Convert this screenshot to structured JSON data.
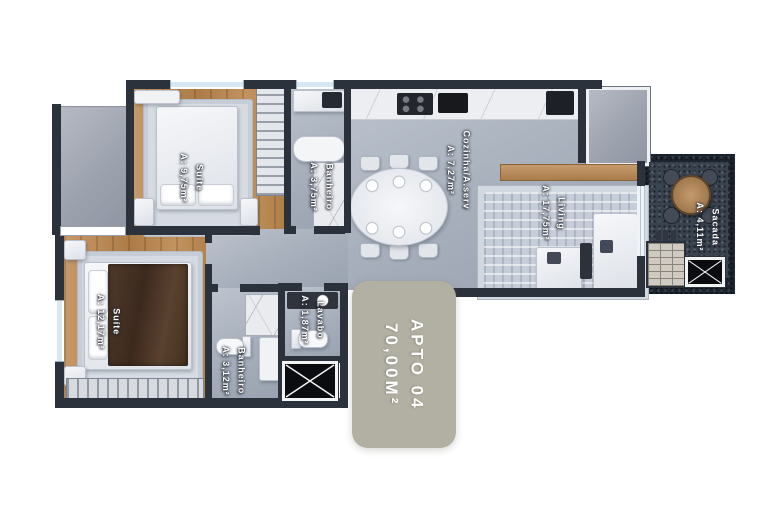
{
  "badge": {
    "title": "APTO 04",
    "area": "70,00M²"
  },
  "rooms": {
    "suite1": {
      "name": "Suíte",
      "area": "A: 9,75m²"
    },
    "banheiro1": {
      "name": "Banheiro",
      "area": "A: 3,75m²"
    },
    "cozinha": {
      "name": "Cozinha/A.serv",
      "area": "A: 7,27m²"
    },
    "living": {
      "name": "Living",
      "area": "A: 17,75m²"
    },
    "sacada": {
      "name": "Sacada",
      "area": "A: 4,11m²"
    },
    "lavabo": {
      "name": "Lavabo",
      "area": "A: 1,87m²"
    },
    "banheiro2": {
      "name": "Banheiro",
      "area": "A: 3,12m²"
    },
    "suite2": {
      "name": "Suíte",
      "area": "A: 12,17m²"
    }
  },
  "colors": {
    "wall": "#2c323c",
    "wood_floor": "#b8884f",
    "tile_floor": "#a6aebb",
    "balcony_floor": "#39424f",
    "badge_bg": "#b2b0a3",
    "label_text": "#ffffff"
  }
}
